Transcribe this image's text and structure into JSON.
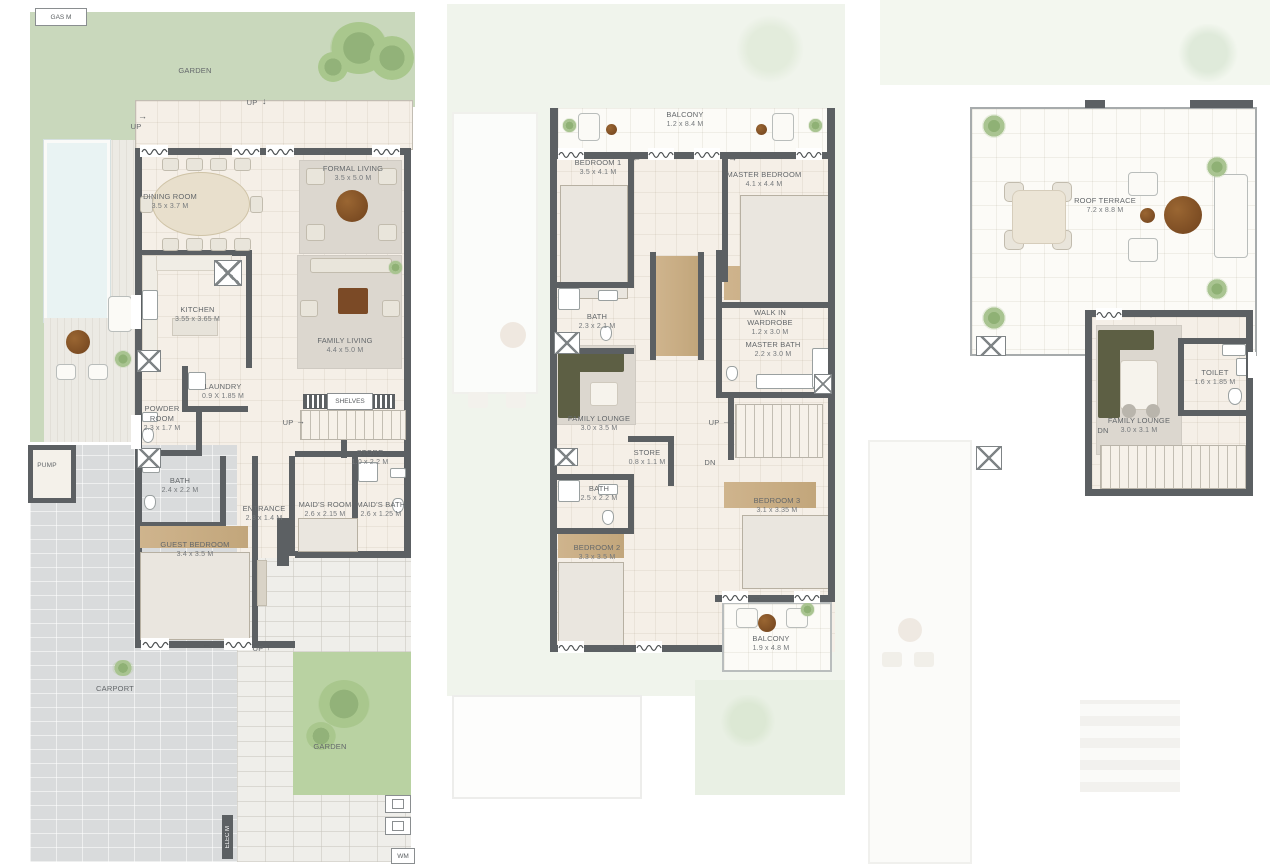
{
  "icons": {
    "arrow_up": "↑",
    "arrow_down": "↓",
    "arrow_left": "←",
    "arrow_right": "→"
  },
  "colors": {
    "wall": "#5c6063",
    "floor": "#f5efe7",
    "garden": "#c9d8bc",
    "garden_bright": "#b9d2a2",
    "carport": "#d9dbdc",
    "wood": "#c9ad85",
    "rug": "#dcd7cf",
    "sofa_green": "#5d5f44",
    "table_brown": "#8a552a",
    "pool": "#e9f3f3",
    "label_text": "#63676a"
  },
  "ground": {
    "gas_meter": "GAS M",
    "garden_top": "GARDEN",
    "garden_bottom": "GARDEN",
    "carport": "CARPORT",
    "pump": "PUMP",
    "elec_meter": "ELEC M",
    "wm": "WM",
    "shelves": "SHELVES",
    "up": "UP",
    "rooms": [
      {
        "name": "DINING ROOM",
        "dims": "3.5 x 3.7 M"
      },
      {
        "name": "FORMAL LIVING",
        "dims": "3.5 x 5.0 M"
      },
      {
        "name": "KITCHEN",
        "dims": "3.55 x 3.65 M"
      },
      {
        "name": "FAMILY LIVING",
        "dims": "4.4 x 5.0 M"
      },
      {
        "name": "LAUNDRY",
        "dims": "0.9 X 1.85 M"
      },
      {
        "name": "POWDER ROOM",
        "dims": "2.3 x 1.7 M"
      },
      {
        "name": "STORE",
        "dims": "1.0 x 2.2 M"
      },
      {
        "name": "BATH",
        "dims": "2.4 x 2.2 M"
      },
      {
        "name": "ENTRANCE",
        "dims": "2.8 x 1.4 M"
      },
      {
        "name": "MAID'S ROOM",
        "dims": "2.6 x 2.15 M"
      },
      {
        "name": "MAID'S BATH",
        "dims": "2.6 x 1.25 M"
      },
      {
        "name": "GUEST BEDROOM",
        "dims": "3.4 x 3.5 M"
      }
    ]
  },
  "first": {
    "up": "UP",
    "dn": "DN",
    "rooms": [
      {
        "name": "BALCONY",
        "dims": "1.2 x 8.4 M"
      },
      {
        "name": "BEDROOM 1",
        "dims": "3.5 x 4.1 M"
      },
      {
        "name": "MASTER BEDROOM",
        "dims": "4.1 x 4.4 M"
      },
      {
        "name": "BATH",
        "dims": "2.3 x 2.1 M"
      },
      {
        "name": "WALK IN WARDROBE",
        "dims": "1.2 x 3.0 M"
      },
      {
        "name": "MASTER BATH",
        "dims": "2.2 x 3.0 M"
      },
      {
        "name": "FAMILY LOUNGE",
        "dims": "3.0 x 3.5 M"
      },
      {
        "name": "STORE",
        "dims": "0.8 x 1.1 M"
      },
      {
        "name": "BATH",
        "dims": "2.5 x 2.2 M"
      },
      {
        "name": "BEDROOM 2",
        "dims": "3.3 x 3.5 M"
      },
      {
        "name": "BEDROOM 3",
        "dims": "3.1 x 3.35 M"
      },
      {
        "name": "BALCONY",
        "dims": "1.9 x 4.8 M"
      }
    ]
  },
  "roof": {
    "dn": "DN",
    "rooms": [
      {
        "name": "ROOF TERRACE",
        "dims": "7.2 x 8.8 M"
      },
      {
        "name": "FAMILY LOUNGE",
        "dims": "3.0 x 3.1 M"
      },
      {
        "name": "TOILET",
        "dims": "1.6 x 1.85 M"
      }
    ]
  }
}
